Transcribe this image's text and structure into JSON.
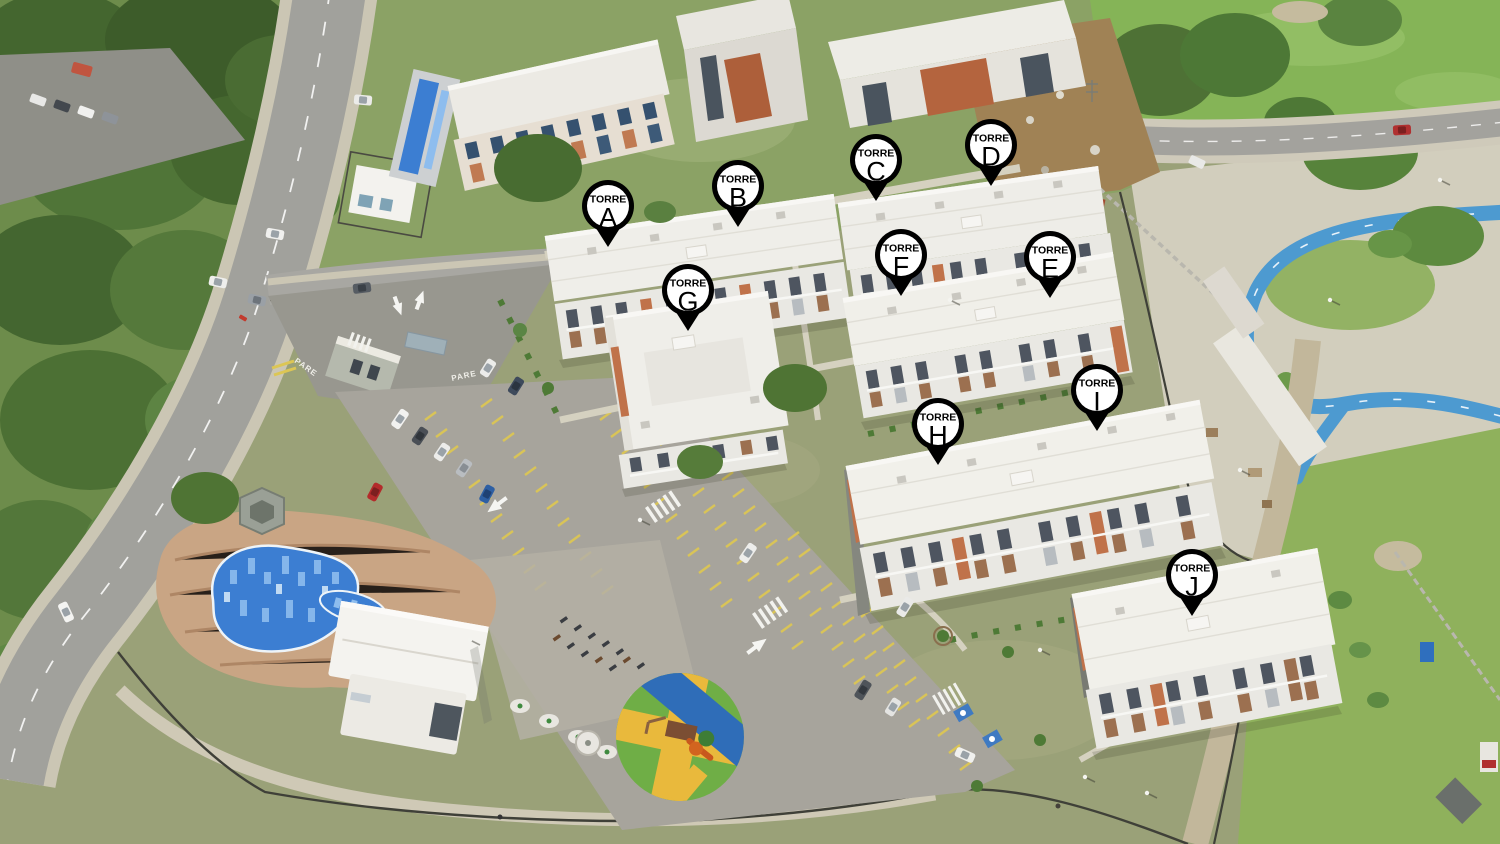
{
  "map": {
    "description": "Aerial drone photograph of a residential apartment complex with swimming pool, parking lot, playground and bike track; ten towers identified by letter pins",
    "marker_prefix": "TORRE",
    "markers": [
      {
        "prefix": "TORRE",
        "letter": "A",
        "x": 608,
        "y": 206
      },
      {
        "prefix": "TORRE",
        "letter": "B",
        "x": 738,
        "y": 186
      },
      {
        "prefix": "TORRE",
        "letter": "C",
        "x": 876,
        "y": 160
      },
      {
        "prefix": "TORRE",
        "letter": "D",
        "x": 991,
        "y": 145
      },
      {
        "prefix": "TORRE",
        "letter": "E",
        "x": 1050,
        "y": 257
      },
      {
        "prefix": "TORRE",
        "letter": "F",
        "x": 901,
        "y": 255
      },
      {
        "prefix": "TORRE",
        "letter": "G",
        "x": 688,
        "y": 290
      },
      {
        "prefix": "TORRE",
        "letter": "H",
        "x": 938,
        "y": 424
      },
      {
        "prefix": "TORRE",
        "letter": "I",
        "x": 1097,
        "y": 390
      },
      {
        "prefix": "TORRE",
        "letter": "J",
        "x": 1192,
        "y": 575
      }
    ]
  },
  "ground": {
    "pare_marking": "PARE"
  },
  "colors": {
    "pin_fill": "#ffffff",
    "pin_border": "#000000",
    "pool_water": "#3c7ed2",
    "bike_track": "#4d9ad0",
    "playground_green": "#6fae46",
    "playground_yellow": "#e9b93c",
    "playground_blue": "#2f6db8",
    "building_accent": "#c0724a",
    "parking_line": "#dcc654"
  }
}
